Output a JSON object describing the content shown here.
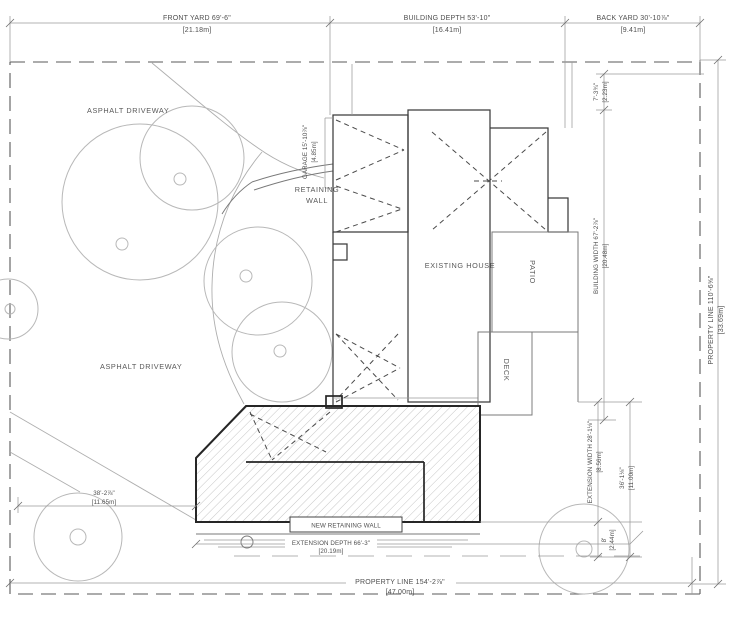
{
  "drawing": {
    "type": "architectural site plan",
    "colors": {
      "boundary": "#5a5a5a",
      "walls": "#3c3c3c",
      "extension_outline": "#262626",
      "hatch": "#c6c6c6",
      "text": "#4f4f4f"
    }
  },
  "dims": {
    "front_yard": {
      "ft": "FRONT YARD 69'-6\"",
      "m": "[21.18m]"
    },
    "building_depth": {
      "ft": "BUILDING DEPTH 53'-10\"",
      "m": "[16.41m]"
    },
    "back_yard": {
      "ft": "BACK YARD 30'-10⅞\"",
      "m": "[9.41m]"
    },
    "top_right_offset": {
      "ft": "7'-3¾\"",
      "m": "[2.23m]"
    },
    "building_width": {
      "ft": "BUILDING WIDTH 67'-2⅞\"",
      "m": "[20.48m]"
    },
    "property_line_right": {
      "ft": "PROPERTY LINE 110'-6⅝\"",
      "m": "[33.69m]"
    },
    "extension_width": {
      "ft": "EXTENSION WIDTH 28'-1⅛\"",
      "m": "[8.56m]"
    },
    "rear_offset": {
      "ft": "36'-1⅛\"",
      "m": "[11.00m]"
    },
    "side_offset": {
      "ft": "8'",
      "m": "[2.44m]"
    },
    "driveway_front": {
      "ft": "38'-2⅞\"",
      "m": "[11.65m]"
    },
    "extension_depth": {
      "ft": "EXTENSION DEPTH 66'-3\"",
      "m": "[20.19m]"
    },
    "property_line_bottom": {
      "ft": "PROPERTY LINE 154'-2⅞\"",
      "m": "[47.00m]"
    },
    "garage": {
      "ft": "GARAGE 15'-10⅞\"",
      "m": "[4.85m]"
    }
  },
  "labels": {
    "asphalt_driveway_upper": "ASPHALT DRIVEWAY",
    "asphalt_driveway_lower": "ASPHALT DRIVEWAY",
    "retaining_wall_1": "RETAINING",
    "retaining_wall_2": "WALL",
    "existing_house": "EXISTING HOUSE",
    "patio": "PATIO",
    "deck": "DECK",
    "new_retaining_wall": "NEW RETAINING WALL"
  }
}
